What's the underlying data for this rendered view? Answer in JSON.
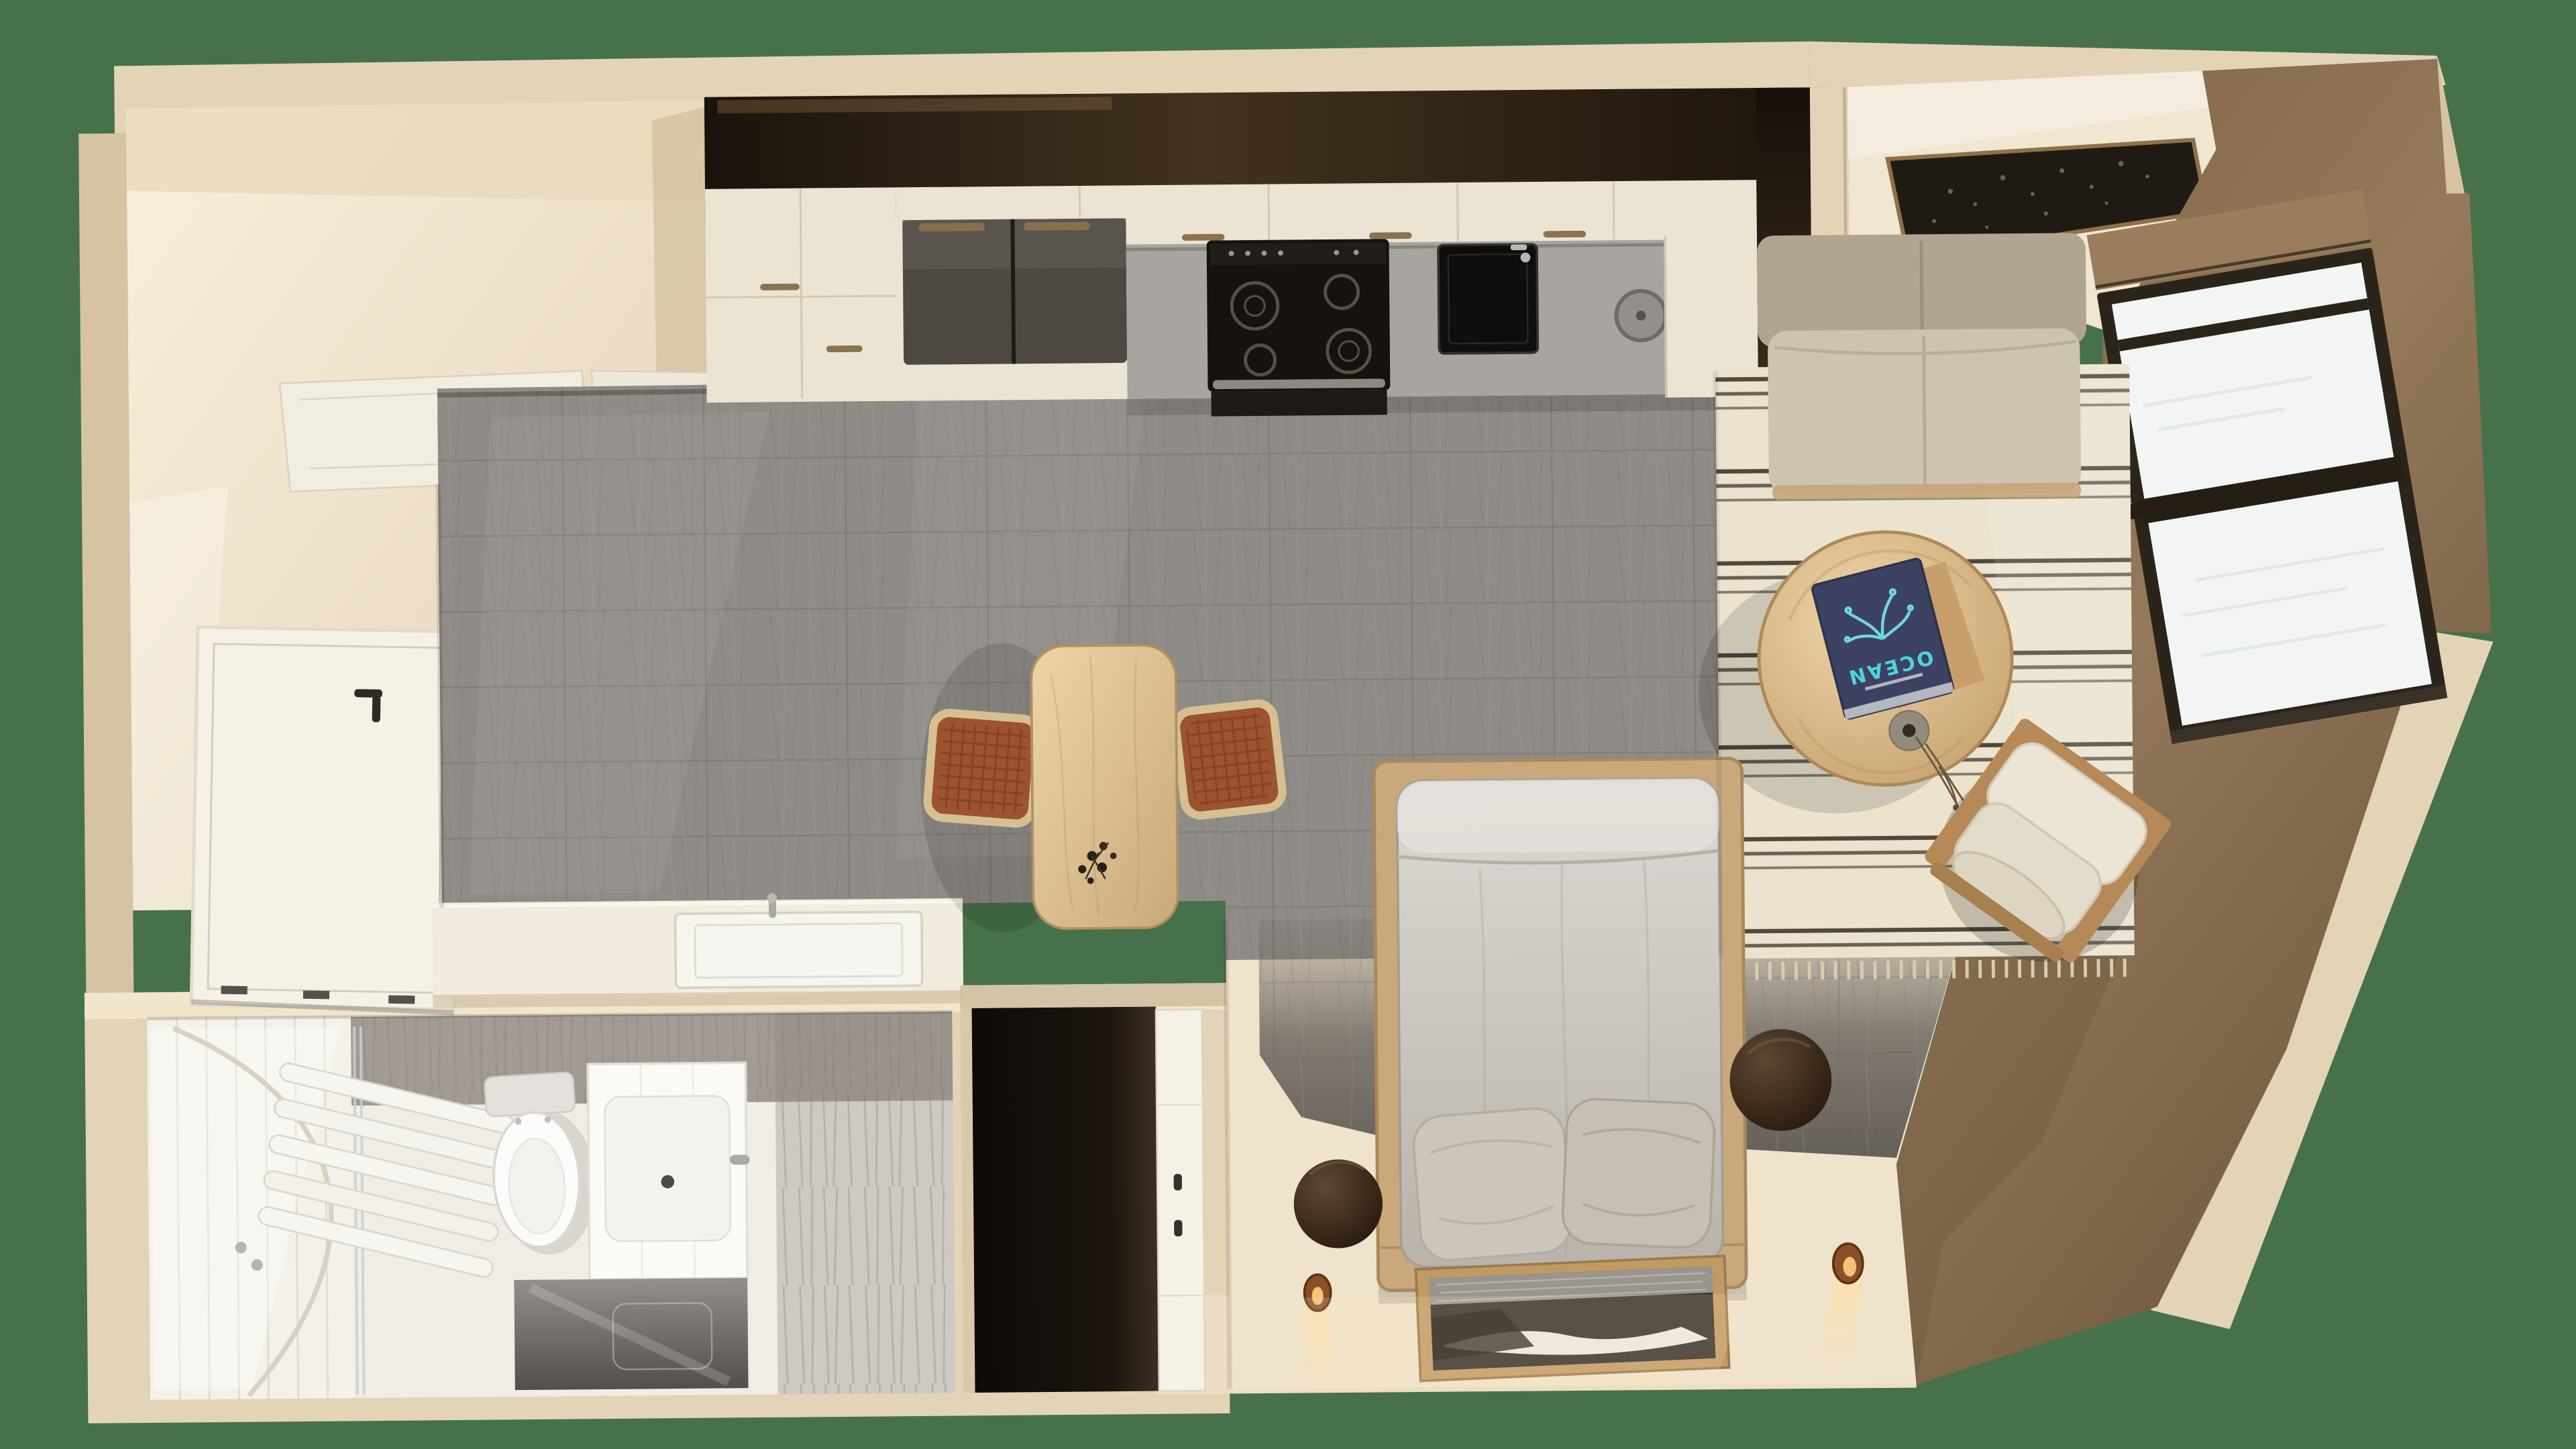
{
  "texts": {
    "book_title": "OCEAN"
  },
  "colors": {
    "background": "#47714a",
    "wall_cream": "#e3d4b8",
    "wall_cream_light": "#f3e9d4",
    "wall_cream_dark": "#d5c3a4",
    "interior_cream": "#f6ecd9",
    "brown_wall": "#8a6f52",
    "brown_wall_dark": "#6d563e",
    "roller_box": "#9a7d5c",
    "floor_tile": "#8f8b86",
    "floor_tile_dark": "#6e6963",
    "bedroom_floor": "#f0e3cb",
    "rug_base": "#ece3cf",
    "rug_stripe": "#3e372e",
    "wood_light": "#e4c99a",
    "wood_mid": "#c6a274",
    "sofa_back": "#b2a58f",
    "sofa_seat": "#cdc3b1",
    "mattress_light": "#dcd8d3",
    "mattress_dark": "#b9b3ab",
    "pillow": "#cbc5ba",
    "bed_platform": "#c9a87c",
    "fridge_gray": "#4e4843",
    "stove_black": "#16130f",
    "counter_gray": "#a8a4a0",
    "cabinet_cream": "#ece4d3",
    "soffit_dark": "#241b11",
    "window_frame": "#2b241b",
    "window_glass": "#f3f5f5",
    "book_cover": "#3d4263",
    "book_text": "#4fd3dc",
    "artwork_dark": "#1f1a14",
    "artwork_frame": "#8f7048",
    "chair_rattan": "#9c5430",
    "chair_frame": "#d6c092",
    "pouf_brown": "#3a2a1c",
    "candle_amber": "#b06f35",
    "bath_white": "#f0ede6",
    "tile_wall_gray": "#a29b94",
    "door_white": "#f6f1e7",
    "niche_dark": "#15100c",
    "armchair_wood": "#b68a58",
    "armchair_cushion": "#ece5d6"
  }
}
